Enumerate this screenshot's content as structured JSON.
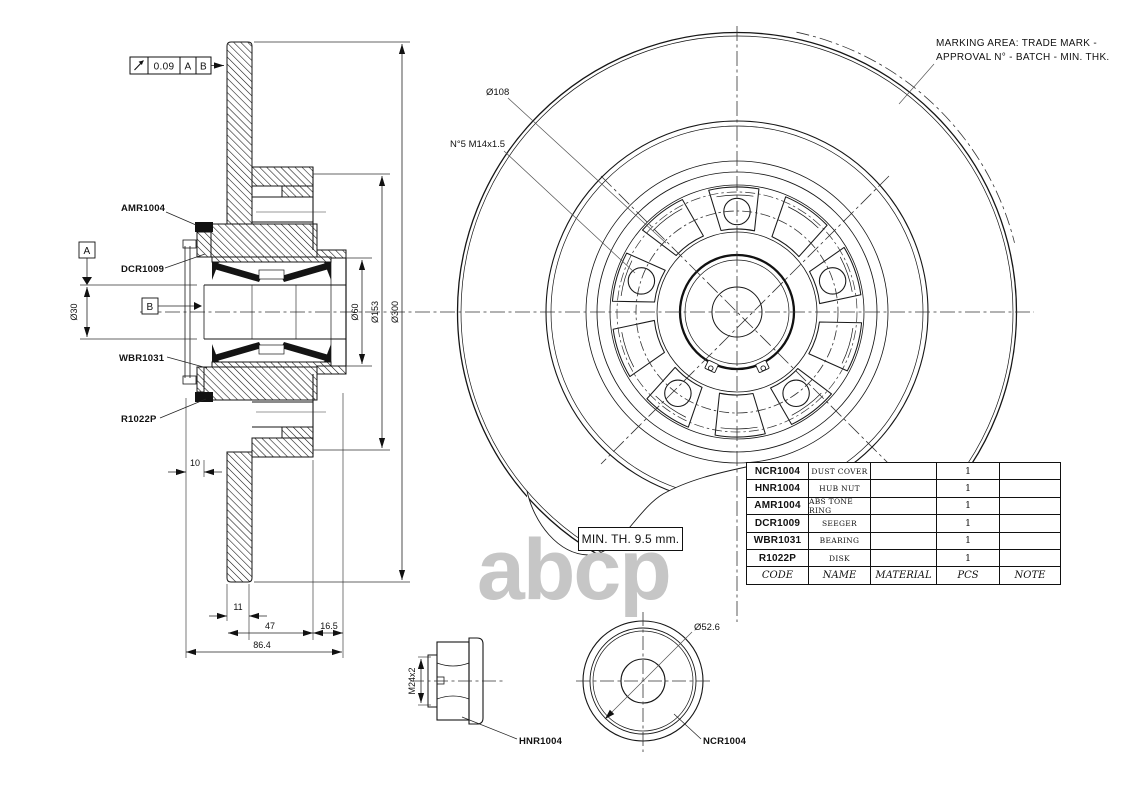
{
  "watermark": "abcp",
  "tolerance": {
    "symbol": "runout-icon",
    "value": "0.09",
    "datum_a": "A",
    "datum_b": "B"
  },
  "datum": {
    "a": "A",
    "b": "B"
  },
  "part_labels": {
    "amr": "AMR1004",
    "dcr": "DCR1009",
    "wbr": "WBR1031",
    "r1022": "R1022P",
    "hnr": "HNR1004",
    "ncr": "NCR1004"
  },
  "dims": {
    "d30": "Ø30",
    "d60": "Ø60",
    "d153": "Ø153",
    "d300": "Ø300",
    "d108": "Ø108",
    "bolts": "N°5 M14x1.5",
    "w10": "10",
    "w11": "11",
    "w47": "47",
    "w16_5": "16.5",
    "w86_4": "86.4",
    "nut_thread": "M24x2",
    "d52_6": "Ø52.6"
  },
  "notes": {
    "min_thickness": "MIN. TH. 9.5 mm.",
    "marking_line1": "MARKING AREA: TRADE MARK -",
    "marking_line2": "APPROVAL N° - BATCH - MIN. THK."
  },
  "bom": {
    "headers": [
      "CODE",
      "NAME",
      "MATERIAL",
      "PCS",
      "NOTE"
    ],
    "rows": [
      {
        "code": "NCR1004",
        "name": "DUST COVER",
        "material": "",
        "pcs": "1",
        "note": ""
      },
      {
        "code": "HNR1004",
        "name": "HUB NUT",
        "material": "",
        "pcs": "1",
        "note": ""
      },
      {
        "code": "AMR1004",
        "name": "ABS TONE RING",
        "material": "",
        "pcs": "1",
        "note": ""
      },
      {
        "code": "DCR1009",
        "name": "SEEGER",
        "material": "",
        "pcs": "1",
        "note": ""
      },
      {
        "code": "WBR1031",
        "name": "BEARING",
        "material": "",
        "pcs": "1",
        "note": ""
      },
      {
        "code": "R1022P",
        "name": "DISK",
        "material": "",
        "pcs": "1",
        "note": ""
      }
    ]
  }
}
